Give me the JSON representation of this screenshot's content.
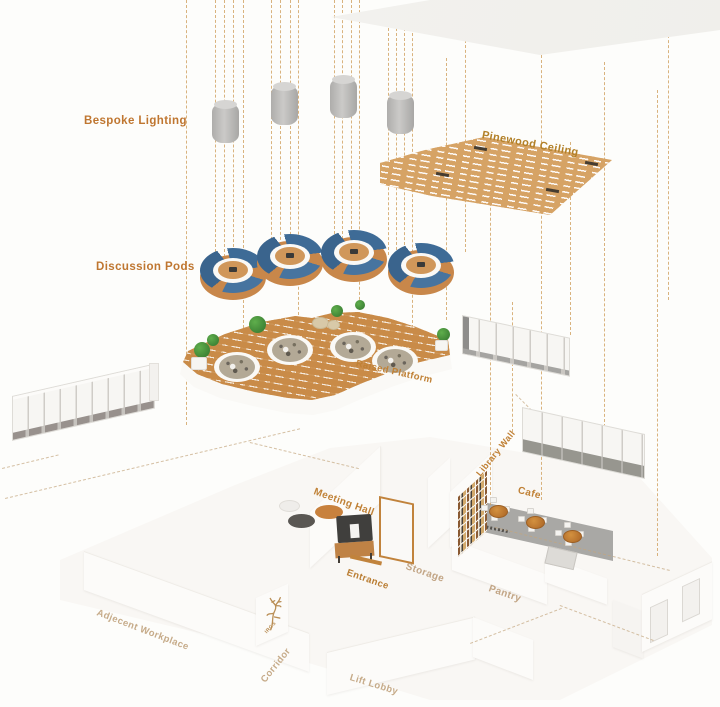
{
  "diagram": {
    "title_labels": {
      "bespoke_lighting": "Bespoke Lighting",
      "discussion_pods": "Discussion Pods"
    },
    "labels": {
      "pinewood_ceiling": "Pinewood Ceiling",
      "raised_platform": "Raised Platform",
      "meeting_hall": "Meeting Hall",
      "library_wall": "Library Wall",
      "cafe": "Cafe",
      "entrance": "Entrance",
      "storage": "Storage",
      "pantry": "Pantry",
      "adjacent_workplace": "Adjecent Workplace",
      "corridor": "Corridor",
      "lift_lobby": "Lift Lobby",
      "logo_text": "IRGS"
    },
    "elements": {
      "pendant_lights_count": 4,
      "discussion_pods_count": 4,
      "platform_seating_clusters_count": 4,
      "cafe_tables_count": 3
    },
    "palette": {
      "label_orange": "#bf7630",
      "label_gold": "#b28028",
      "label_tan": "#c6ab89",
      "wood_ceiling": "#d6a365",
      "wood_platform": "#c98b48",
      "pod_blue": "#3e6b96",
      "pod_wood": "#c8874a",
      "pendant_gray": "#b3b2b0",
      "cafe_floor_gray": "#a9a8a5",
      "dashed_line": "#d0a05f",
      "wall_white": "#fcfbf9"
    }
  }
}
